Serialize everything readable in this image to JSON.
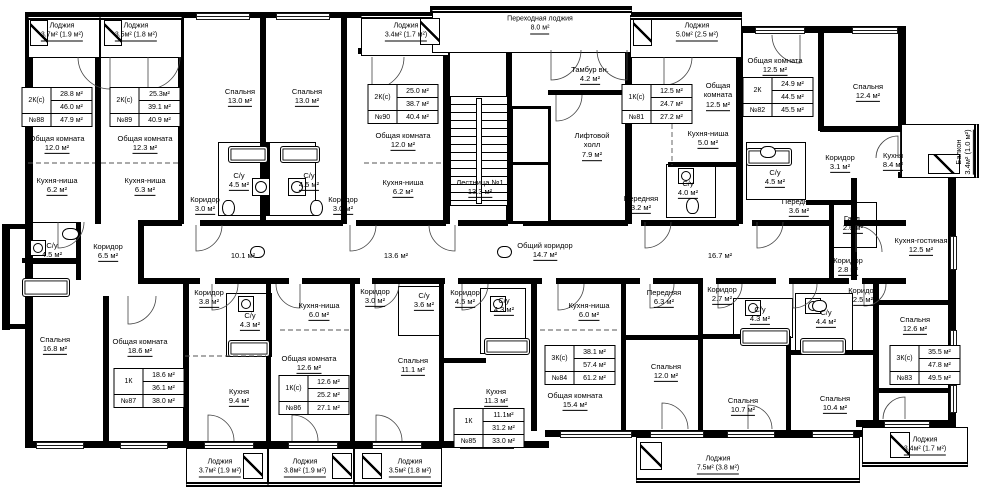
{
  "drawing": {
    "room_labels": [
      {
        "name": "Общая комната",
        "area": "12.0 м²",
        "x": 57,
        "y": 144
      },
      {
        "name": "Кухня-ниша",
        "area": "6.2 м²",
        "x": 57,
        "y": 186
      },
      {
        "name": "Общая комната",
        "area": "12.3 м²",
        "x": 145,
        "y": 144
      },
      {
        "name": "Кухня-ниша",
        "area": "6.3 м²",
        "x": 145,
        "y": 186
      },
      {
        "name": "Спальня",
        "area": "13.0 м²",
        "x": 240,
        "y": 97
      },
      {
        "name": "Спальня",
        "area": "13.0 м²",
        "x": 307,
        "y": 97
      },
      {
        "name": "С/у",
        "area": "4.5 м²",
        "x": 239,
        "y": 181
      },
      {
        "name": "С/у",
        "area": "4.5 м²",
        "x": 309,
        "y": 181
      },
      {
        "name": "Коридор",
        "area": "3.0 м²",
        "x": 205,
        "y": 205
      },
      {
        "name": "Коридор",
        "area": "3.0 м²",
        "x": 343,
        "y": 205
      },
      {
        "name": "Общая комната",
        "area": "12.0 м²",
        "x": 403,
        "y": 141
      },
      {
        "name": "Кухня-ниша",
        "area": "6.2 м²",
        "x": 403,
        "y": 188
      },
      {
        "name": "Лестница  №1",
        "area": "13.3 м²",
        "x": 480,
        "y": 188
      },
      {
        "name": "Тамбур вн.",
        "area": "4.2 м²",
        "x": 590,
        "y": 75
      },
      {
        "name": "Лифтовой холл",
        "area": "7.9 м²",
        "x": 592,
        "y": 146,
        "w": 48,
        "wrap": 1
      },
      {
        "name": "Общая комната",
        "area": "12.5 м²",
        "x": 718,
        "y": 96,
        "w": 54,
        "wrap": 1
      },
      {
        "name": "Кухня-ниша",
        "area": "5.0 м²",
        "x": 708,
        "y": 139
      },
      {
        "name": "С/у",
        "area": "4.0 м²",
        "x": 688,
        "y": 189
      },
      {
        "name": "Передняя",
        "area": "3.2 м²",
        "x": 641,
        "y": 204
      },
      {
        "name": "Общая комната",
        "area": "12.5 м²",
        "x": 775,
        "y": 66
      },
      {
        "name": "Спальня",
        "area": "12.4 м²",
        "x": 868,
        "y": 92
      },
      {
        "name": "Коридор",
        "area": "3.1 м²",
        "x": 840,
        "y": 163
      },
      {
        "name": "Кухня",
        "area": "8.4 м²",
        "x": 893,
        "y": 161
      },
      {
        "name": "С/у",
        "area": "4.5 м²",
        "x": 775,
        "y": 178
      },
      {
        "name": "Передняя",
        "area": "3.6 м²",
        "x": 799,
        "y": 207
      },
      {
        "name": "Гард.",
        "area": "2.6 м²",
        "x": 853,
        "y": 224
      },
      {
        "name": "С/у",
        "area": "4.5 м²",
        "x": 52,
        "y": 251
      },
      {
        "name": "Коридор",
        "area": "6.5 м²",
        "x": 108,
        "y": 252
      },
      {
        "name": "",
        "area": "10.1 м²",
        "x": 243,
        "y": 256
      },
      {
        "name": "",
        "area": "13.6 м²",
        "x": 396,
        "y": 256
      },
      {
        "name": "Общий коридор",
        "area": "14.7 м²",
        "x": 545,
        "y": 251
      },
      {
        "name": "",
        "area": "16.7 м²",
        "x": 720,
        "y": 256
      },
      {
        "name": "Коридор",
        "area": "2.8 м²",
        "x": 848,
        "y": 266
      },
      {
        "name": "Кухня-гостиная",
        "area": "12.5 м²",
        "x": 921,
        "y": 246,
        "w": 62,
        "wrap": 1
      },
      {
        "name": "Коридор",
        "area": "3.8 м²",
        "x": 209,
        "y": 298
      },
      {
        "name": "С/у",
        "area": "4.3 м²",
        "x": 250,
        "y": 321
      },
      {
        "name": "Кухня-ниша",
        "area": "6.0 м²",
        "x": 319,
        "y": 311
      },
      {
        "name": "Коридор",
        "area": "3.0 м²",
        "x": 375,
        "y": 297
      },
      {
        "name": "С/у",
        "area": "3.6 м²",
        "x": 424,
        "y": 301
      },
      {
        "name": "Коридор",
        "area": "4.5 м²",
        "x": 465,
        "y": 298
      },
      {
        "name": "С/у",
        "area": "4.3 м²",
        "x": 504,
        "y": 306
      },
      {
        "name": "Кухня-ниша",
        "area": "6.0 м²",
        "x": 589,
        "y": 311
      },
      {
        "name": "Передняя",
        "area": "6.3 м²",
        "x": 664,
        "y": 298
      },
      {
        "name": "Коридор",
        "area": "2.7 м²",
        "x": 722,
        "y": 295
      },
      {
        "name": "С/у",
        "area": "4.3 м²",
        "x": 760,
        "y": 315
      },
      {
        "name": "С/у",
        "area": "4.4 м²",
        "x": 826,
        "y": 318
      },
      {
        "name": "Коридор",
        "area": "2.5 м²",
        "x": 863,
        "y": 296
      },
      {
        "name": "Спальня",
        "area": "12.6 м²",
        "x": 915,
        "y": 325
      },
      {
        "name": "Спальня",
        "area": "16.8 м²",
        "x": 55,
        "y": 345
      },
      {
        "name": "Общая комната",
        "area": "18.6 м²",
        "x": 140,
        "y": 347
      },
      {
        "name": "Кухня",
        "area": "9.4 м²",
        "x": 239,
        "y": 397
      },
      {
        "name": "Общая комната",
        "area": "12.6 м²",
        "x": 309,
        "y": 364
      },
      {
        "name": "Спальня",
        "area": "11.1 м²",
        "x": 413,
        "y": 366
      },
      {
        "name": "Кухня",
        "area": "11.3 м²",
        "x": 496,
        "y": 397
      },
      {
        "name": "Общая комната",
        "area": "15.4 м²",
        "x": 575,
        "y": 401
      },
      {
        "name": "Спальня",
        "area": "12.0 м²",
        "x": 666,
        "y": 372
      },
      {
        "name": "Спальня",
        "area": "10.7 м²",
        "x": 743,
        "y": 406
      },
      {
        "name": "Спальня",
        "area": "10.4 м²",
        "x": 835,
        "y": 404
      },
      {
        "name": "Балкон",
        "area": "3.4м² (1.0 м²)",
        "x": 964,
        "y": 152,
        "rot": 1
      }
    ],
    "loggia_labels": [
      {
        "name": "Лоджия",
        "area": "3.7м² (1.9 м²)",
        "x": 62,
        "y": 32
      },
      {
        "name": "Лоджия",
        "area": "3.5м² (1.8 м²)",
        "x": 136,
        "y": 32
      },
      {
        "name": "Лоджия",
        "area": "3.4м² (1.7 м²)",
        "x": 406,
        "y": 32
      },
      {
        "name": "Переходная лоджия",
        "area": "8.0 м²",
        "x": 540,
        "y": 25
      },
      {
        "name": "Лоджия",
        "area": "5.0м² (2.5 м²)",
        "x": 697,
        "y": 32
      },
      {
        "name": "Лоджия",
        "area": "3.7м² (1.9 м²)",
        "x": 220,
        "y": 468
      },
      {
        "name": "Лоджия",
        "area": "3.8м² (1.9 м²)",
        "x": 305,
        "y": 468
      },
      {
        "name": "Лоджия",
        "area": "3.5м² (1.8 м²)",
        "x": 410,
        "y": 468
      },
      {
        "name": "Лоджия",
        "area": "7.5м² (3.8 м²)",
        "x": 718,
        "y": 465
      },
      {
        "name": "Лоджия",
        "area": "3.4м² (1.7 м²)",
        "x": 925,
        "y": 446
      }
    ],
    "apartment_tables": [
      {
        "type": "2К(с)",
        "living": "28.8 м²",
        "area": "46.0 м²",
        "number": "№88",
        "total": "47.9 м²",
        "x": 57,
        "y": 107
      },
      {
        "type": "2К(с)",
        "living": "25.3м²",
        "area": "39.1 м²",
        "number": "№89",
        "total": "40.9 м²",
        "x": 145,
        "y": 107
      },
      {
        "type": "2К(с)",
        "living": "25.0 м²",
        "area": "38.7 м²",
        "number": "№90",
        "total": "40.4 м²",
        "x": 403,
        "y": 104
      },
      {
        "type": "1К(с)",
        "living": "12.5 м²",
        "area": "24.7 м²",
        "number": "№81",
        "total": "27.2 м²",
        "x": 657,
        "y": 104
      },
      {
        "type": "2К",
        "living": "24.9 м²",
        "area": "44.5 м²",
        "number": "№82",
        "total": "45.5 м²",
        "x": 778,
        "y": 97
      },
      {
        "type": "3К(с)",
        "living": "35.5 м²",
        "area": "47.8 м²",
        "number": "№83",
        "total": "49.5 м²",
        "x": 925,
        "y": 365
      },
      {
        "type": "3К(с)",
        "living": "38.1 м²",
        "area": "57.4 м²",
        "number": "№84",
        "total": "61.2 м²",
        "x": 580,
        "y": 365
      },
      {
        "type": "1К",
        "living": "11.1м²",
        "area": "31.2 м²",
        "number": "№85",
        "total": "33.0 м²",
        "x": 489,
        "y": 428
      },
      {
        "type": "1К(с)",
        "living": "12.6 м²",
        "area": "25.2 м²",
        "number": "№86",
        "total": "27.1 м²",
        "x": 314,
        "y": 395
      },
      {
        "type": "1К",
        "living": "18.6 м²",
        "area": "36.1 м²",
        "number": "№87",
        "total": "38.0 м²",
        "x": 149,
        "y": 388
      }
    ]
  }
}
